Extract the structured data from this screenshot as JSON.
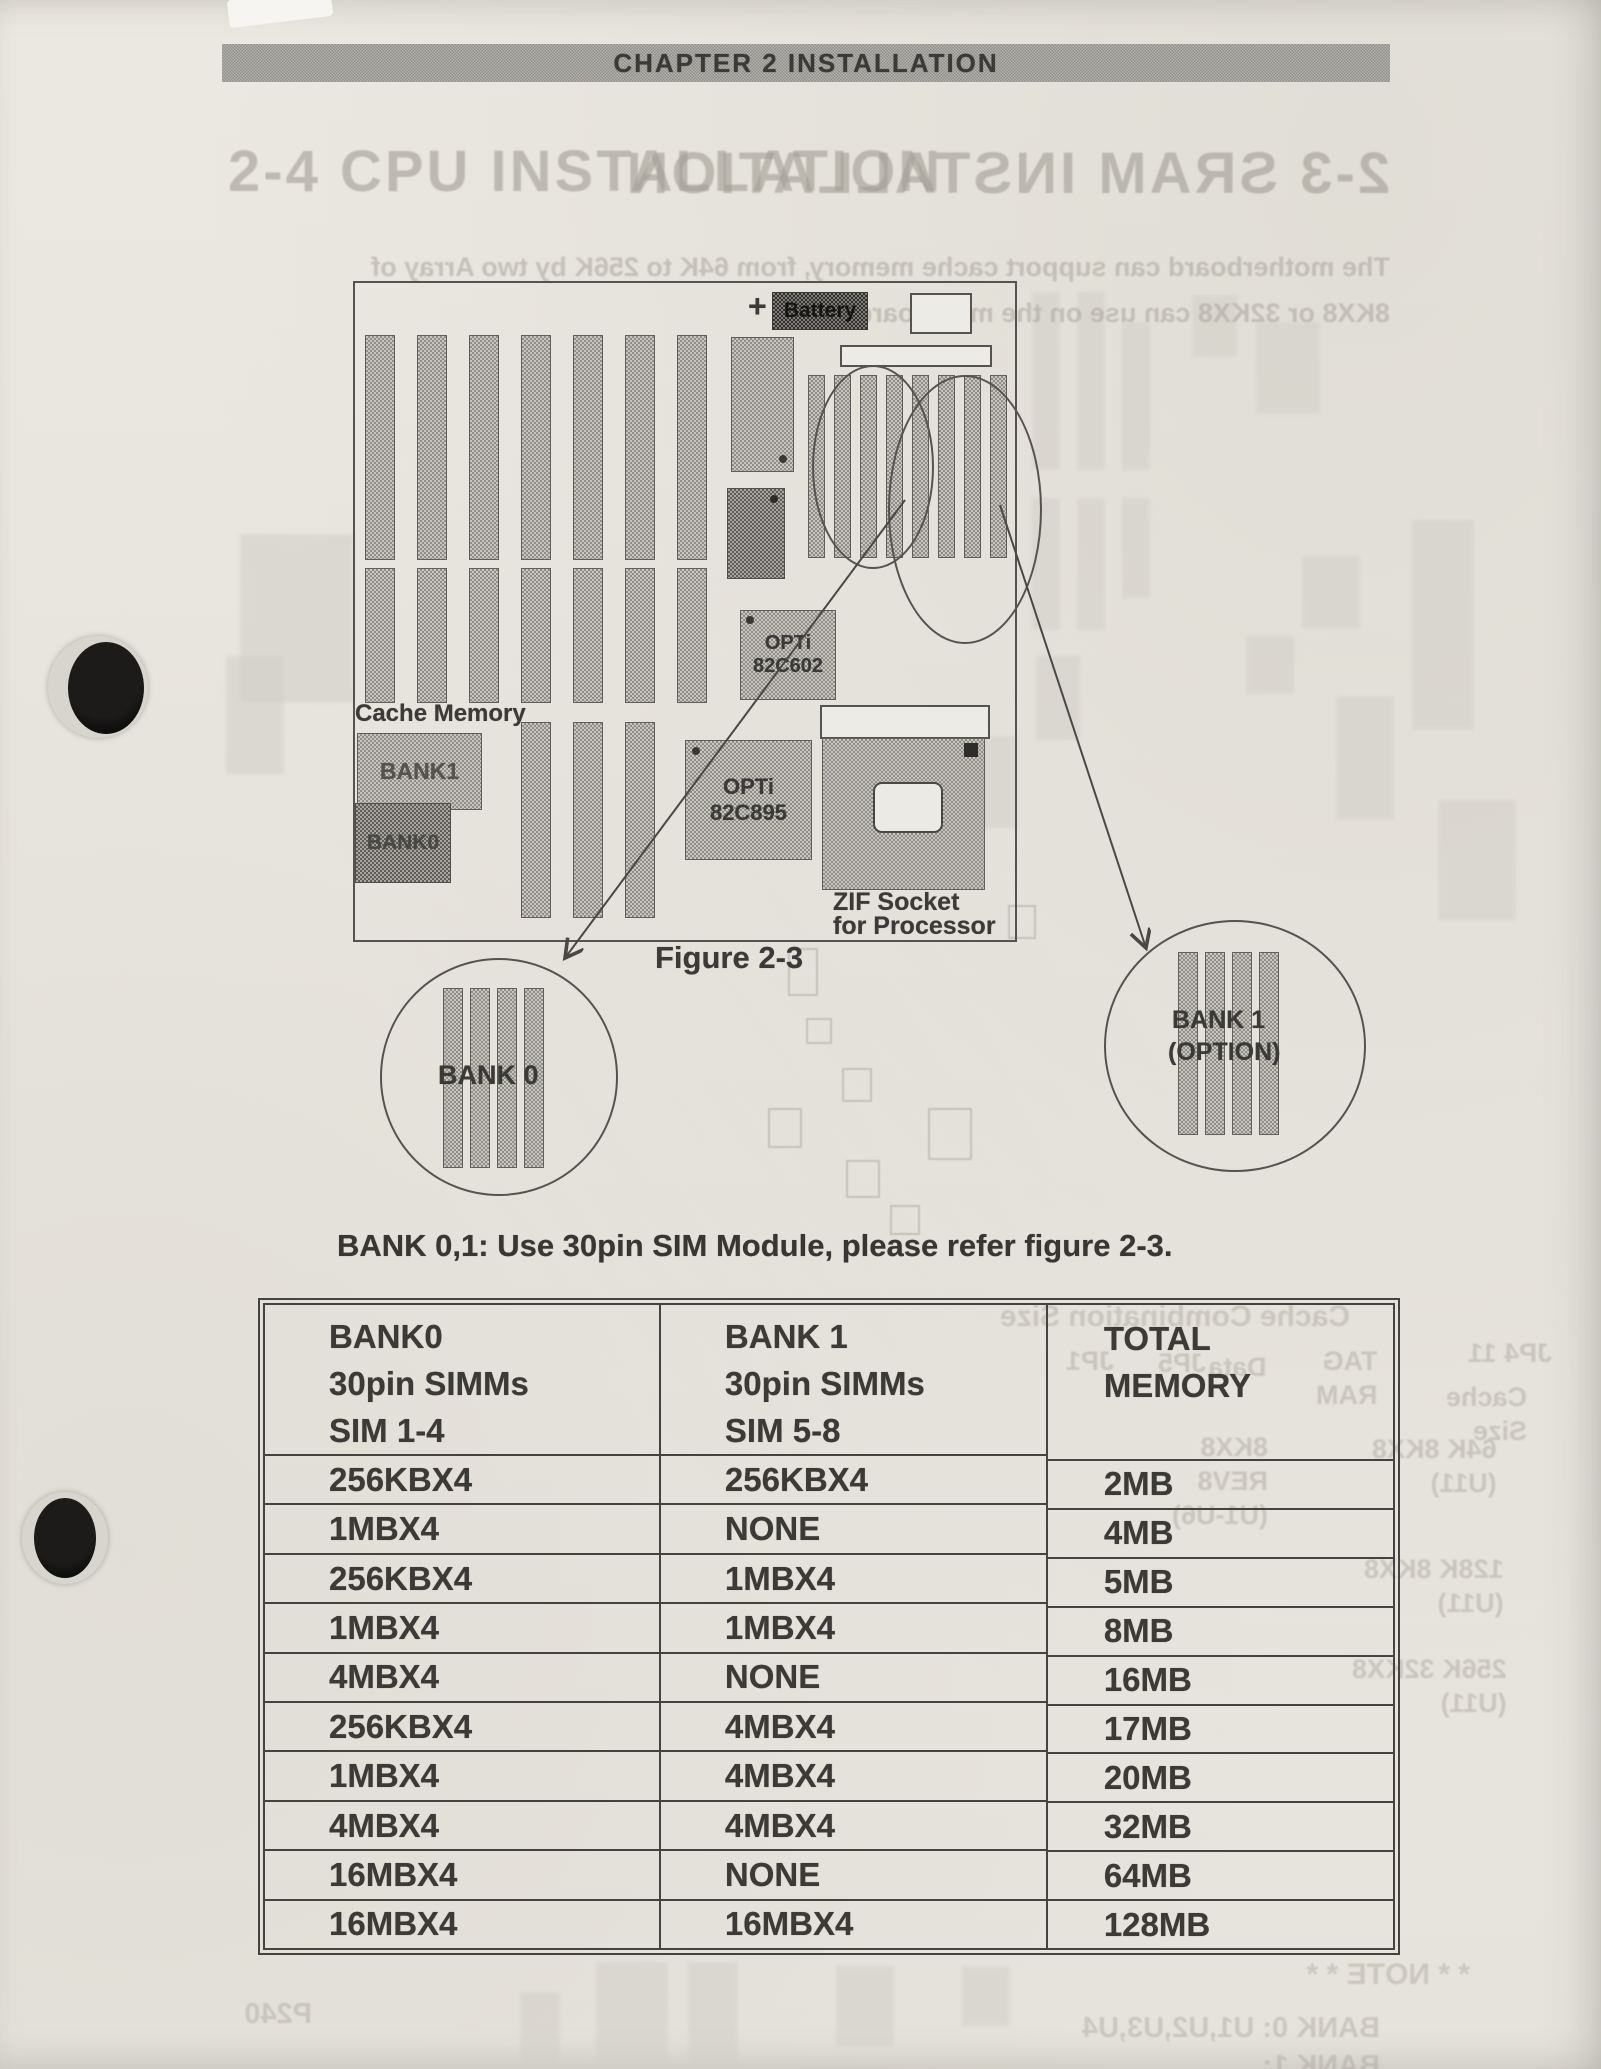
{
  "page": {
    "header": "CHAPTER 2  INSTALLATION"
  },
  "ghost": {
    "title_front": "2-4 CPU INSTALLATION",
    "title_back": "2-3 SRAM INSTALLATION",
    "para_line1": "The motherboard can support cache memory, from 64K to 256K by two Array of",
    "para_line2": "8KX8 or 32KX8 can use on the mainboard",
    "table_caption": "Cache Combination Size",
    "note": "* * NOTE * *",
    "bank0_note": "BANK 0: U1,U2,U3,U4",
    "bank1_note": "BANK 1: U7,U8,U9,U10",
    "page_num": "P240",
    "labels": [
      "JP1",
      "JP5",
      "Data",
      "TAG\nRAM",
      "JP4 11",
      "Cache\nSize",
      "64K   8KX8\n(U11)",
      "8KX8\nREV8\n(U1-U6)",
      "128K   8KX8\n(U11)",
      "256K   32KX8\n(U11)"
    ]
  },
  "figure": {
    "battery_plus": "+",
    "battery_label": "Battery",
    "cache_memory_label": "Cache Memory",
    "cache_bank1_label": "BANK1",
    "cache_bank0_label": "BANK0",
    "chip1_line1": "OPTi",
    "chip1_line2": "82C602",
    "chip2_line1": "OPTi",
    "chip2_line2": "82C895",
    "zif_line1": "ZIF Socket",
    "zif_line2": "for Processor",
    "caption": "Figure 2-3",
    "callout_left_label": "BANK 0",
    "callout_right_line1": "BANK 1",
    "callout_right_line2": "(OPTION)"
  },
  "note_line": "BANK 0,1: Use 30pin SIM Module, please refer figure 2-3.",
  "table": {
    "col1_header": [
      "BANK0",
      "30pin SIMMs",
      "SIM 1-4"
    ],
    "col2_header": [
      "BANK 1",
      "30pin SIMMs",
      "SIM 5-8"
    ],
    "col3_header": [
      "TOTAL",
      "MEMORY"
    ],
    "rows": [
      {
        "bank0": "256KBX4",
        "bank1": "256KBX4",
        "total": "2MB"
      },
      {
        "bank0": "1MBX4",
        "bank1": "NONE",
        "total": "4MB"
      },
      {
        "bank0": "256KBX4",
        "bank1": "1MBX4",
        "total": "5MB"
      },
      {
        "bank0": "1MBX4",
        "bank1": "1MBX4",
        "total": "8MB"
      },
      {
        "bank0": "4MBX4",
        "bank1": "NONE",
        "total": "16MB"
      },
      {
        "bank0": "256KBX4",
        "bank1": "4MBX4",
        "total": "17MB"
      },
      {
        "bank0": "1MBX4",
        "bank1": "4MBX4",
        "total": "20MB"
      },
      {
        "bank0": "4MBX4",
        "bank1": "4MBX4",
        "total": "32MB"
      },
      {
        "bank0": "16MBX4",
        "bank1": "NONE",
        "total": "64MB"
      },
      {
        "bank0": "16MBX4",
        "bank1": "16MBX4",
        "total": "128MB"
      }
    ]
  }
}
